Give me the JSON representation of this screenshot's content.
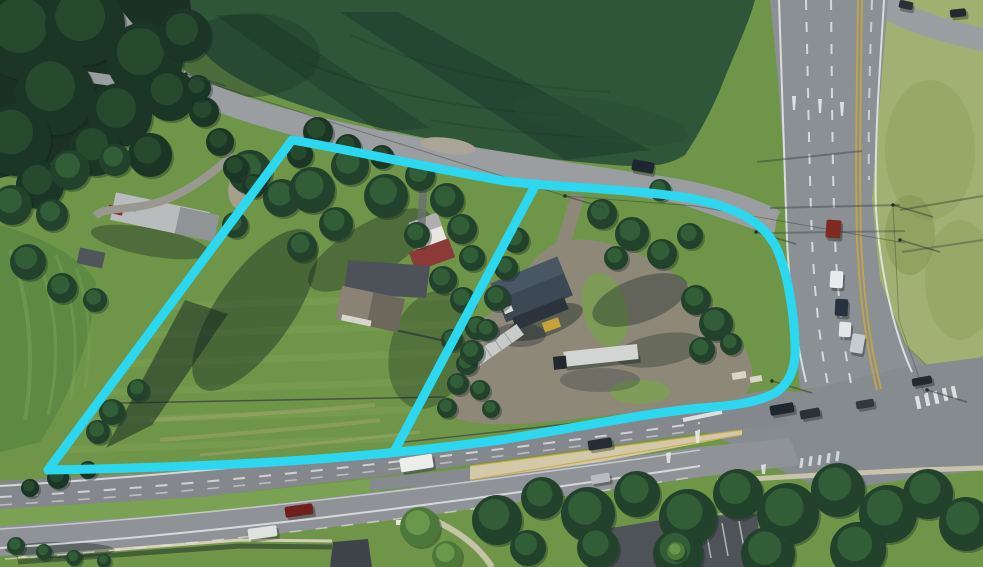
{
  "image": {
    "kind": "aerial-photograph-with-parcel-annotation",
    "width": 983,
    "height": 567
  },
  "palette": {
    "annotation_cyan": "#2BD8EF",
    "crop_field_green": "#30563A",
    "lawn_green": "#6F9549",
    "light_grass": "#A2B173",
    "road_gray": "#8B9094",
    "highway_gray": "#85898D",
    "gravel_tan": "#8E8878",
    "median_concrete": "#D3C9A8",
    "lane_yellow": "#C9A83B",
    "marking_white": "#E8EAEA"
  },
  "annotation": {
    "color": "#2BD8EF",
    "stroke_width": 9,
    "outer_path": "M 48 470 L 292 140 C 350 150 430 168 505 181 C 545 187 640 189 694 199 C 738 208 763 222 776 247 C 787 270 794 310 795 345 C 796 365 791 383 775 393 C 757 403 730 406 700 408 C 640 414 575 428 500 440 C 340 462 200 467 48 470 Z",
    "divider_path": "M 536 184 L 395 450"
  },
  "scene": {
    "trees": [
      {
        "x": 25,
        "y": 35,
        "r": 45,
        "t": "d"
      },
      {
        "x": 85,
        "y": 25,
        "r": 40,
        "t": "d"
      },
      {
        "x": 145,
        "y": 60,
        "r": 38,
        "t": "d"
      },
      {
        "x": 55,
        "y": 95,
        "r": 40,
        "t": "d"
      },
      {
        "x": 15,
        "y": 140,
        "r": 36,
        "t": "d"
      },
      {
        "x": 120,
        "y": 115,
        "r": 32,
        "t": "d"
      },
      {
        "x": 185,
        "y": 35,
        "r": 26,
        "t": "d"
      },
      {
        "x": 170,
        "y": 95,
        "r": 26,
        "t": "d"
      },
      {
        "x": 95,
        "y": 150,
        "r": 26,
        "t": "d"
      },
      {
        "x": 40,
        "y": 185,
        "r": 24,
        "t": "d"
      },
      {
        "x": 150,
        "y": 155,
        "r": 22,
        "t": "d"
      },
      {
        "x": 12,
        "y": 205,
        "r": 20,
        "t": "m"
      },
      {
        "x": 70,
        "y": 170,
        "r": 20,
        "t": "m"
      },
      {
        "x": 115,
        "y": 160,
        "r": 16,
        "t": "m"
      },
      {
        "x": 250,
        "y": 172,
        "r": 22,
        "t": "m"
      },
      {
        "x": 282,
        "y": 198,
        "r": 19,
        "t": "m"
      },
      {
        "x": 235,
        "y": 225,
        "r": 13,
        "t": "m"
      },
      {
        "x": 52,
        "y": 215,
        "r": 16,
        "t": "m"
      },
      {
        "x": 28,
        "y": 262,
        "r": 18,
        "t": "m"
      },
      {
        "x": 62,
        "y": 288,
        "r": 15,
        "t": "m"
      },
      {
        "x": 95,
        "y": 300,
        "r": 12,
        "t": "m"
      },
      {
        "x": 204,
        "y": 112,
        "r": 15,
        "t": "d"
      },
      {
        "x": 220,
        "y": 142,
        "r": 14,
        "t": "d"
      },
      {
        "x": 236,
        "y": 168,
        "r": 13,
        "t": "d"
      },
      {
        "x": 254,
        "y": 186,
        "r": 12,
        "t": "d"
      },
      {
        "x": 198,
        "y": 88,
        "r": 13,
        "t": "d"
      },
      {
        "x": 318,
        "y": 132,
        "r": 15,
        "t": "d"
      },
      {
        "x": 348,
        "y": 147,
        "r": 13,
        "t": "d"
      },
      {
        "x": 382,
        "y": 157,
        "r": 12,
        "t": "d"
      },
      {
        "x": 300,
        "y": 155,
        "r": 13,
        "t": "d"
      },
      {
        "x": 312,
        "y": 190,
        "r": 23,
        "t": "m"
      },
      {
        "x": 350,
        "y": 166,
        "r": 19,
        "t": "m"
      },
      {
        "x": 386,
        "y": 196,
        "r": 22,
        "t": "m"
      },
      {
        "x": 336,
        "y": 224,
        "r": 17,
        "t": "m"
      },
      {
        "x": 302,
        "y": 247,
        "r": 15,
        "t": "m"
      },
      {
        "x": 420,
        "y": 176,
        "r": 15,
        "t": "m"
      },
      {
        "x": 447,
        "y": 200,
        "r": 17,
        "t": "m"
      },
      {
        "x": 417,
        "y": 235,
        "r": 13,
        "t": "m"
      },
      {
        "x": 462,
        "y": 229,
        "r": 15,
        "t": "m"
      },
      {
        "x": 472,
        "y": 258,
        "r": 13,
        "t": "m"
      },
      {
        "x": 443,
        "y": 280,
        "r": 14,
        "t": "m"
      },
      {
        "x": 463,
        "y": 300,
        "r": 13,
        "t": "m"
      },
      {
        "x": 477,
        "y": 328,
        "r": 12,
        "t": "m"
      },
      {
        "x": 452,
        "y": 340,
        "r": 11,
        "t": "m"
      },
      {
        "x": 467,
        "y": 364,
        "r": 11,
        "t": "m"
      },
      {
        "x": 480,
        "y": 390,
        "r": 10,
        "t": "m"
      },
      {
        "x": 491,
        "y": 409,
        "r": 9,
        "t": "m"
      },
      {
        "x": 516,
        "y": 240,
        "r": 13,
        "t": "m"
      },
      {
        "x": 506,
        "y": 268,
        "r": 12,
        "t": "m"
      },
      {
        "x": 497,
        "y": 298,
        "r": 13,
        "t": "m"
      },
      {
        "x": 487,
        "y": 330,
        "r": 11,
        "t": "m"
      },
      {
        "x": 472,
        "y": 352,
        "r": 12,
        "t": "m"
      },
      {
        "x": 458,
        "y": 384,
        "r": 11,
        "t": "m"
      },
      {
        "x": 447,
        "y": 408,
        "r": 10,
        "t": "m"
      },
      {
        "x": 602,
        "y": 214,
        "r": 15,
        "t": "m"
      },
      {
        "x": 632,
        "y": 234,
        "r": 17,
        "t": "m"
      },
      {
        "x": 662,
        "y": 254,
        "r": 15,
        "t": "m"
      },
      {
        "x": 690,
        "y": 236,
        "r": 13,
        "t": "m"
      },
      {
        "x": 616,
        "y": 258,
        "r": 12,
        "t": "m"
      },
      {
        "x": 660,
        "y": 190,
        "r": 11,
        "t": "m"
      },
      {
        "x": 696,
        "y": 300,
        "r": 15,
        "t": "m"
      },
      {
        "x": 716,
        "y": 324,
        "r": 17,
        "t": "m"
      },
      {
        "x": 702,
        "y": 350,
        "r": 13,
        "t": "m"
      },
      {
        "x": 731,
        "y": 344,
        "r": 11,
        "t": "m"
      },
      {
        "x": 112,
        "y": 412,
        "r": 13,
        "t": "m"
      },
      {
        "x": 138,
        "y": 390,
        "r": 11,
        "t": "m"
      },
      {
        "x": 98,
        "y": 432,
        "r": 12,
        "t": "m"
      },
      {
        "x": 58,
        "y": 478,
        "r": 11,
        "t": "d"
      },
      {
        "x": 88,
        "y": 470,
        "r": 9,
        "t": "d"
      },
      {
        "x": 30,
        "y": 488,
        "r": 9,
        "t": "d"
      },
      {
        "x": 497,
        "y": 520,
        "r": 25,
        "t": "m"
      },
      {
        "x": 542,
        "y": 498,
        "r": 21,
        "t": "m"
      },
      {
        "x": 588,
        "y": 514,
        "r": 27,
        "t": "m"
      },
      {
        "x": 637,
        "y": 494,
        "r": 23,
        "t": "m"
      },
      {
        "x": 688,
        "y": 518,
        "r": 29,
        "t": "m"
      },
      {
        "x": 738,
        "y": 494,
        "r": 25,
        "t": "m"
      },
      {
        "x": 788,
        "y": 514,
        "r": 31,
        "t": "m"
      },
      {
        "x": 838,
        "y": 490,
        "r": 27,
        "t": "m"
      },
      {
        "x": 888,
        "y": 514,
        "r": 29,
        "t": "m"
      },
      {
        "x": 928,
        "y": 494,
        "r": 25,
        "t": "m"
      },
      {
        "x": 966,
        "y": 524,
        "r": 27,
        "t": "m"
      },
      {
        "x": 858,
        "y": 550,
        "r": 28,
        "t": "m"
      },
      {
        "x": 768,
        "y": 554,
        "r": 27,
        "t": "m"
      },
      {
        "x": 678,
        "y": 554,
        "r": 25,
        "t": "m"
      },
      {
        "x": 598,
        "y": 548,
        "r": 21,
        "t": "m"
      },
      {
        "x": 528,
        "y": 548,
        "r": 18,
        "t": "m"
      },
      {
        "x": 420,
        "y": 527,
        "r": 20,
        "t": "l"
      },
      {
        "x": 447,
        "y": 556,
        "r": 15,
        "t": "l"
      },
      {
        "x": 676,
        "y": 551,
        "r": 9,
        "t": "l"
      },
      {
        "x": 16,
        "y": 546,
        "r": 9,
        "t": "m"
      },
      {
        "x": 44,
        "y": 552,
        "r": 8,
        "t": "m"
      },
      {
        "x": 74,
        "y": 558,
        "r": 8,
        "t": "m"
      },
      {
        "x": 104,
        "y": 561,
        "r": 7,
        "t": "m"
      }
    ],
    "vehicles": [
      {
        "x": 632,
        "y": 161,
        "w": 22,
        "h": 11,
        "a": 10,
        "c": "#1d2531"
      },
      {
        "x": 826,
        "y": 220,
        "w": 15,
        "h": 18,
        "a": 4,
        "c": "#7c2b22"
      },
      {
        "x": 830,
        "y": 271,
        "w": 13,
        "h": 17,
        "a": 3,
        "c": "#e9eaec"
      },
      {
        "x": 835,
        "y": 299,
        "w": 13,
        "h": 17,
        "a": 3,
        "c": "#28323e"
      },
      {
        "x": 839,
        "y": 322,
        "w": 12,
        "h": 15,
        "a": 3,
        "c": "#e3e5e7"
      },
      {
        "x": 851,
        "y": 334,
        "w": 13,
        "h": 19,
        "a": 10,
        "c": "#c7cbd0"
      },
      {
        "x": 950,
        "y": 9,
        "w": 16,
        "h": 8,
        "a": -6,
        "c": "#23292f"
      },
      {
        "x": 899,
        "y": 1,
        "w": 14,
        "h": 8,
        "a": 12,
        "c": "#2a3036"
      },
      {
        "x": 400,
        "y": 456,
        "w": 33,
        "h": 14,
        "a": -9,
        "c": "#eceee9"
      },
      {
        "x": 588,
        "y": 439,
        "w": 24,
        "h": 10,
        "a": -9,
        "c": "#272d34"
      },
      {
        "x": 285,
        "y": 505,
        "w": 28,
        "h": 11,
        "a": -8,
        "c": "#70201c"
      },
      {
        "x": 248,
        "y": 527,
        "w": 29,
        "h": 11,
        "a": -8,
        "c": "#e0e2df"
      },
      {
        "x": 591,
        "y": 474,
        "w": 19,
        "h": 9,
        "a": -9,
        "c": "#b8bcc1"
      },
      {
        "x": 770,
        "y": 404,
        "w": 24,
        "h": 10,
        "a": -10,
        "c": "#20262e"
      },
      {
        "x": 800,
        "y": 409,
        "w": 20,
        "h": 9,
        "a": -10,
        "c": "#2c3138"
      },
      {
        "x": 856,
        "y": 400,
        "w": 18,
        "h": 8,
        "a": -10,
        "c": "#33383f"
      },
      {
        "x": 912,
        "y": 377,
        "w": 20,
        "h": 8,
        "a": -10,
        "c": "#23292f"
      }
    ],
    "poles": [
      {
        "x": 186,
        "y": 74
      },
      {
        "x": 565,
        "y": 196
      },
      {
        "x": 694,
        "y": 200
      },
      {
        "x": 772,
        "y": 381
      },
      {
        "x": 893,
        "y": 205
      },
      {
        "x": 900,
        "y": 240
      },
      {
        "x": 927,
        "y": 390
      },
      {
        "x": 756,
        "y": 232
      }
    ]
  }
}
